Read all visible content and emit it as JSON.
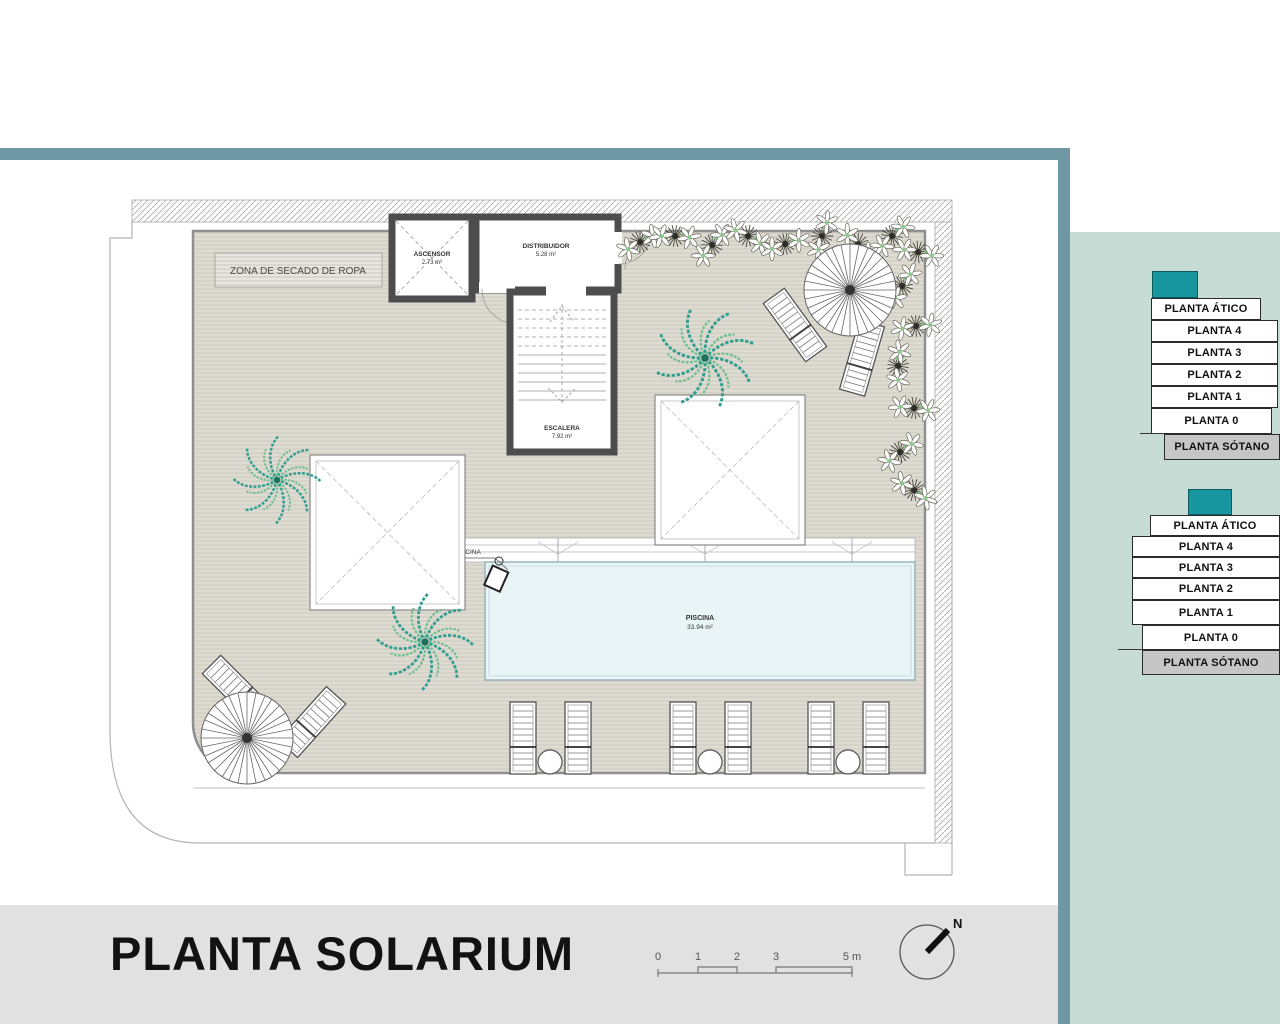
{
  "page": {
    "title_label": "PLANTA SOLARIUM"
  },
  "plan": {
    "zone_label": "ZONA DE SECADO DE ROPA",
    "hoist_label": "GRÚA ELEVABLE DE PISCINA",
    "rooms": {
      "ascensor": {
        "name": "ASCENSOR",
        "area": "2.73 m²"
      },
      "distribuidor": {
        "name": "DISTRIBUIDOR",
        "area": "5.28 m²"
      },
      "escalera": {
        "name": "ESCALERA",
        "area": "7.92 m²"
      },
      "piscina": {
        "name": "PISCINA",
        "area": "33.94 m²"
      }
    }
  },
  "scale_bar": {
    "ticks": [
      "0",
      "1",
      "2",
      "3",
      "5 m"
    ]
  },
  "compass": {
    "north_label": "N"
  },
  "floor_selectors": {
    "stack1": {
      "floors": [
        "PLANTA ÁTICO",
        "PLANTA 4",
        "PLANTA 3",
        "PLANTA 2",
        "PLANTA 1",
        "PLANTA 0",
        "PLANTA SÓTANO"
      ]
    },
    "stack2": {
      "floors": [
        "PLANTA ÁTICO",
        "PLANTA 4",
        "PLANTA 3",
        "PLANTA 2",
        "PLANTA 1",
        "PLANTA 0",
        "PLANTA SÓTANO"
      ]
    }
  },
  "colors": {
    "frame_teal": "#6f98a4",
    "panel_teal": "#c7dcd4",
    "accent_teal": "#18969f",
    "bottom_bar_gray": "#e1e1e1",
    "pool_blue": "#e9f4f6",
    "deck_beige": "#dedbd2",
    "sotano_gray": "#c6c6c6"
  }
}
